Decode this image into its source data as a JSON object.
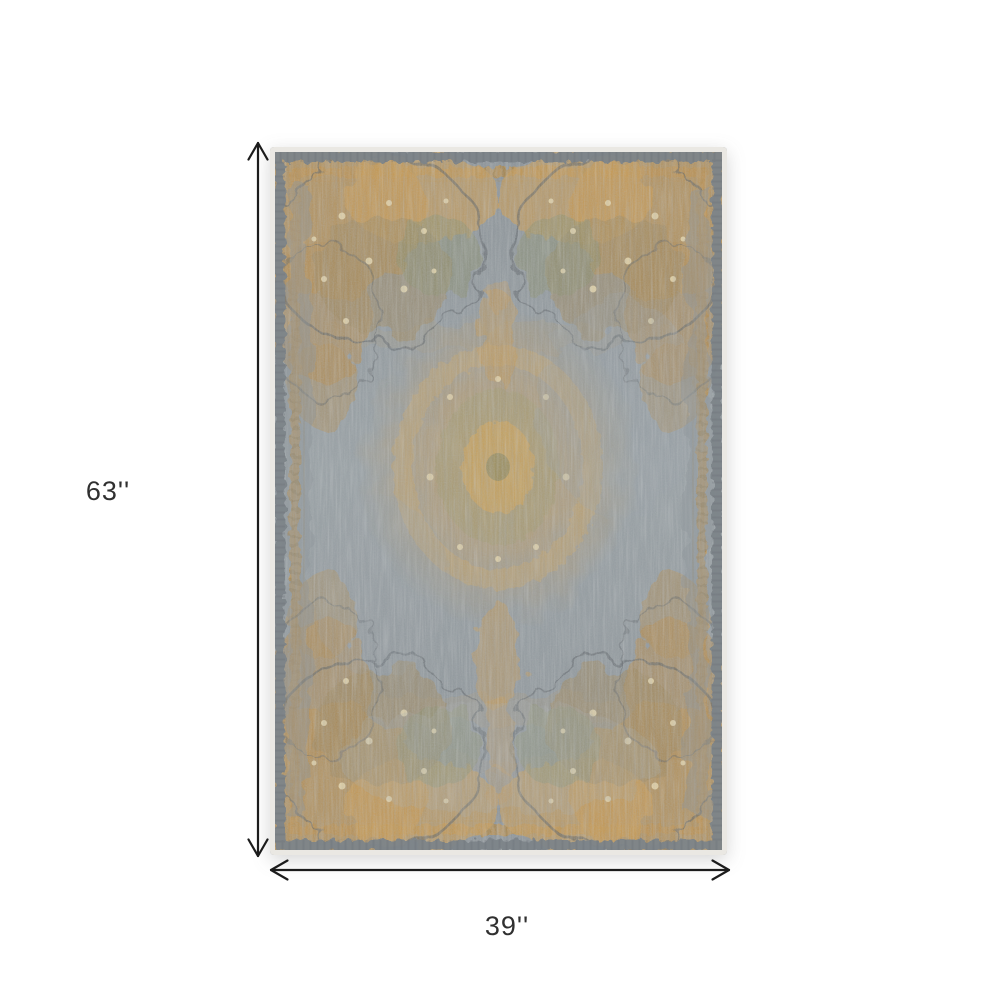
{
  "page": {
    "background": "#ffffff"
  },
  "product_image": {
    "alt": "Distressed vintage medallion area rug, slate gray field with gold, tan and olive ornament",
    "colors": {
      "field_light": "#9aa2a6",
      "field": "#929aa0",
      "field_dark": "#8d9499",
      "band_gray": "#7d8489",
      "edge_light": "#eae8e3",
      "gold": "#bf9554",
      "gold_dark": "#8a6f3e",
      "tan": "#bd9355",
      "olive": "#8e9172",
      "cream": "#e6d7ae",
      "outline": "#5d6266"
    }
  },
  "dimensions": {
    "arrow_color": "#1c1c1c",
    "height": {
      "label": "63''"
    },
    "width": {
      "label": "39''"
    }
  }
}
